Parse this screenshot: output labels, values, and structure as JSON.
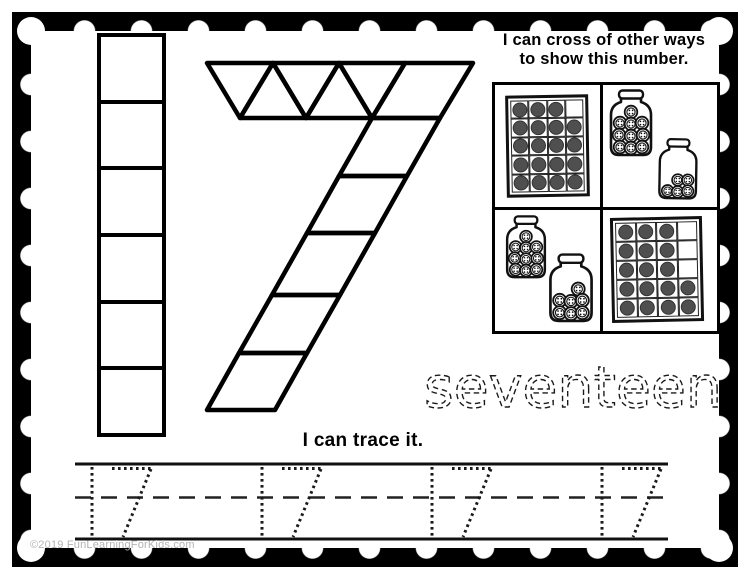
{
  "worksheet": {
    "number": "17",
    "number_word": "seventeen",
    "copyright": "©2019 FunLearningForKids.com"
  },
  "big_number": {
    "value": "17",
    "one_square_blocks": 6,
    "seven_triangle_blocks": 5,
    "seven_rhombus_blocks": 6,
    "total_blocks": 17
  },
  "cross_off": {
    "instruction_line1": "I can cross of other ways",
    "instruction_line2": "to show this number.",
    "quadrants": [
      {
        "type": "twenty-frame",
        "dot_count": 19,
        "filled": [
          [
            1,
            1,
            1,
            0
          ],
          [
            1,
            1,
            1,
            1
          ],
          [
            1,
            1,
            1,
            1
          ],
          [
            1,
            1,
            1,
            1
          ],
          [
            1,
            1,
            1,
            1
          ]
        ]
      },
      {
        "type": "button-jars",
        "jar_button_counts": [
          10,
          5
        ],
        "total": 15
      },
      {
        "type": "button-jars",
        "jar_button_counts": [
          10,
          7
        ],
        "total": 17
      },
      {
        "type": "twenty-frame",
        "dot_count": 17,
        "filled": [
          [
            1,
            1,
            1,
            0
          ],
          [
            1,
            1,
            1,
            0
          ],
          [
            1,
            1,
            1,
            0
          ],
          [
            1,
            1,
            1,
            1
          ],
          [
            1,
            1,
            1,
            1
          ]
        ]
      }
    ]
  },
  "trace_word": {
    "text": "seventeen"
  },
  "trace_section": {
    "label": "I can trace it.",
    "numeral": "17",
    "repetitions": 4
  },
  "colors": {
    "ink": "#000000",
    "dot_fill": "#4f4f4f",
    "trace_gray": "#1a1a1a",
    "copyright_gray": "#b3b3b3"
  }
}
